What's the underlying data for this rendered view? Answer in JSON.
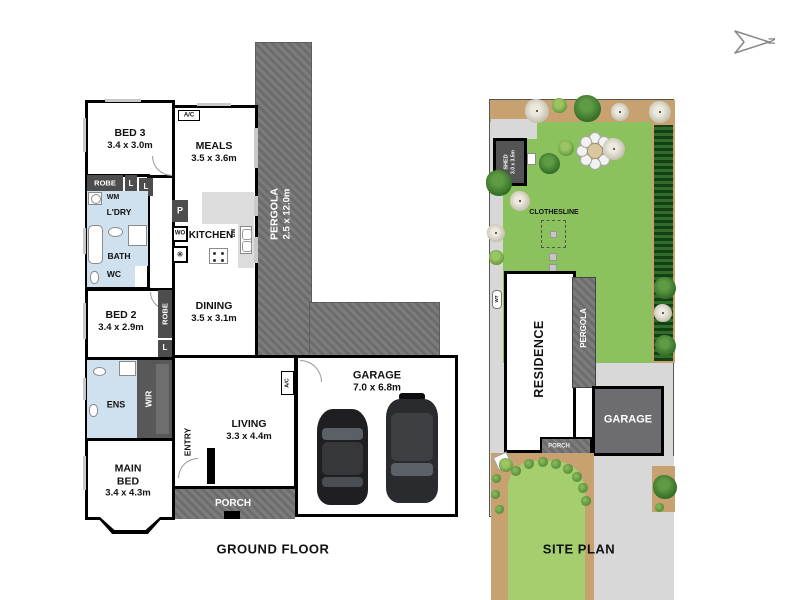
{
  "north_label": "N",
  "ground_floor": {
    "caption": "GROUND FLOOR",
    "bed3": {
      "name": "BED 3",
      "dims": "3.4 x 3.0m"
    },
    "meals": {
      "name": "MEALS",
      "dims": "3.5 x 3.6m"
    },
    "pergola": {
      "name": "PERGOLA",
      "dims": "2.5 x 12.0m"
    },
    "kitchen": "KITCHEN",
    "dining": {
      "name": "DINING",
      "dims": "3.5 x 3.1m"
    },
    "living": {
      "name": "LIVING",
      "dims": "3.3 x 4.4m"
    },
    "bed2": {
      "name": "BED 2",
      "dims": "3.4 x 2.9m"
    },
    "main_bed": {
      "name": "MAIN BED",
      "dims": "3.4 x 4.3m"
    },
    "garage": {
      "name": "GARAGE",
      "dims": "7.0 x 6.8m"
    },
    "ens": "ENS",
    "wir": "WIR",
    "entry": "ENTRY",
    "porch": "PORCH",
    "bath": "BATH",
    "wc": "WC",
    "ldry": "L'DRY",
    "wm": "WM",
    "robe": "ROBE",
    "linen": "L",
    "pantry": "P",
    "wall_oven": "WO",
    "dishwasher": "DW",
    "fridge_symbol": "✳",
    "ac": "A/C"
  },
  "site_plan": {
    "caption": "SITE PLAN",
    "shed": {
      "name": "SHED",
      "dims": "3.0 x 3.5m"
    },
    "clothesline": "CLOTHESLINE",
    "residence": "RESIDENCE",
    "pergola": "PERGOLA",
    "garage": "GARAGE",
    "porch": "PORCH",
    "water_tank": "WT"
  },
  "colors": {
    "wall": "#000000",
    "pergola_hatch": "#757575",
    "wet_floor": "#cfe0ef",
    "cabinet_dark": "#4d4d4d",
    "bench_gray": "#dcdcdc",
    "lawn_back": "#8cc25e",
    "lawn_front": "#a5cf6f",
    "garden_tan": "#c8a170",
    "hedge_green": "#1e5c20",
    "path_gray": "#d8d8d8",
    "site_garage_gray": "#6c6c71"
  }
}
